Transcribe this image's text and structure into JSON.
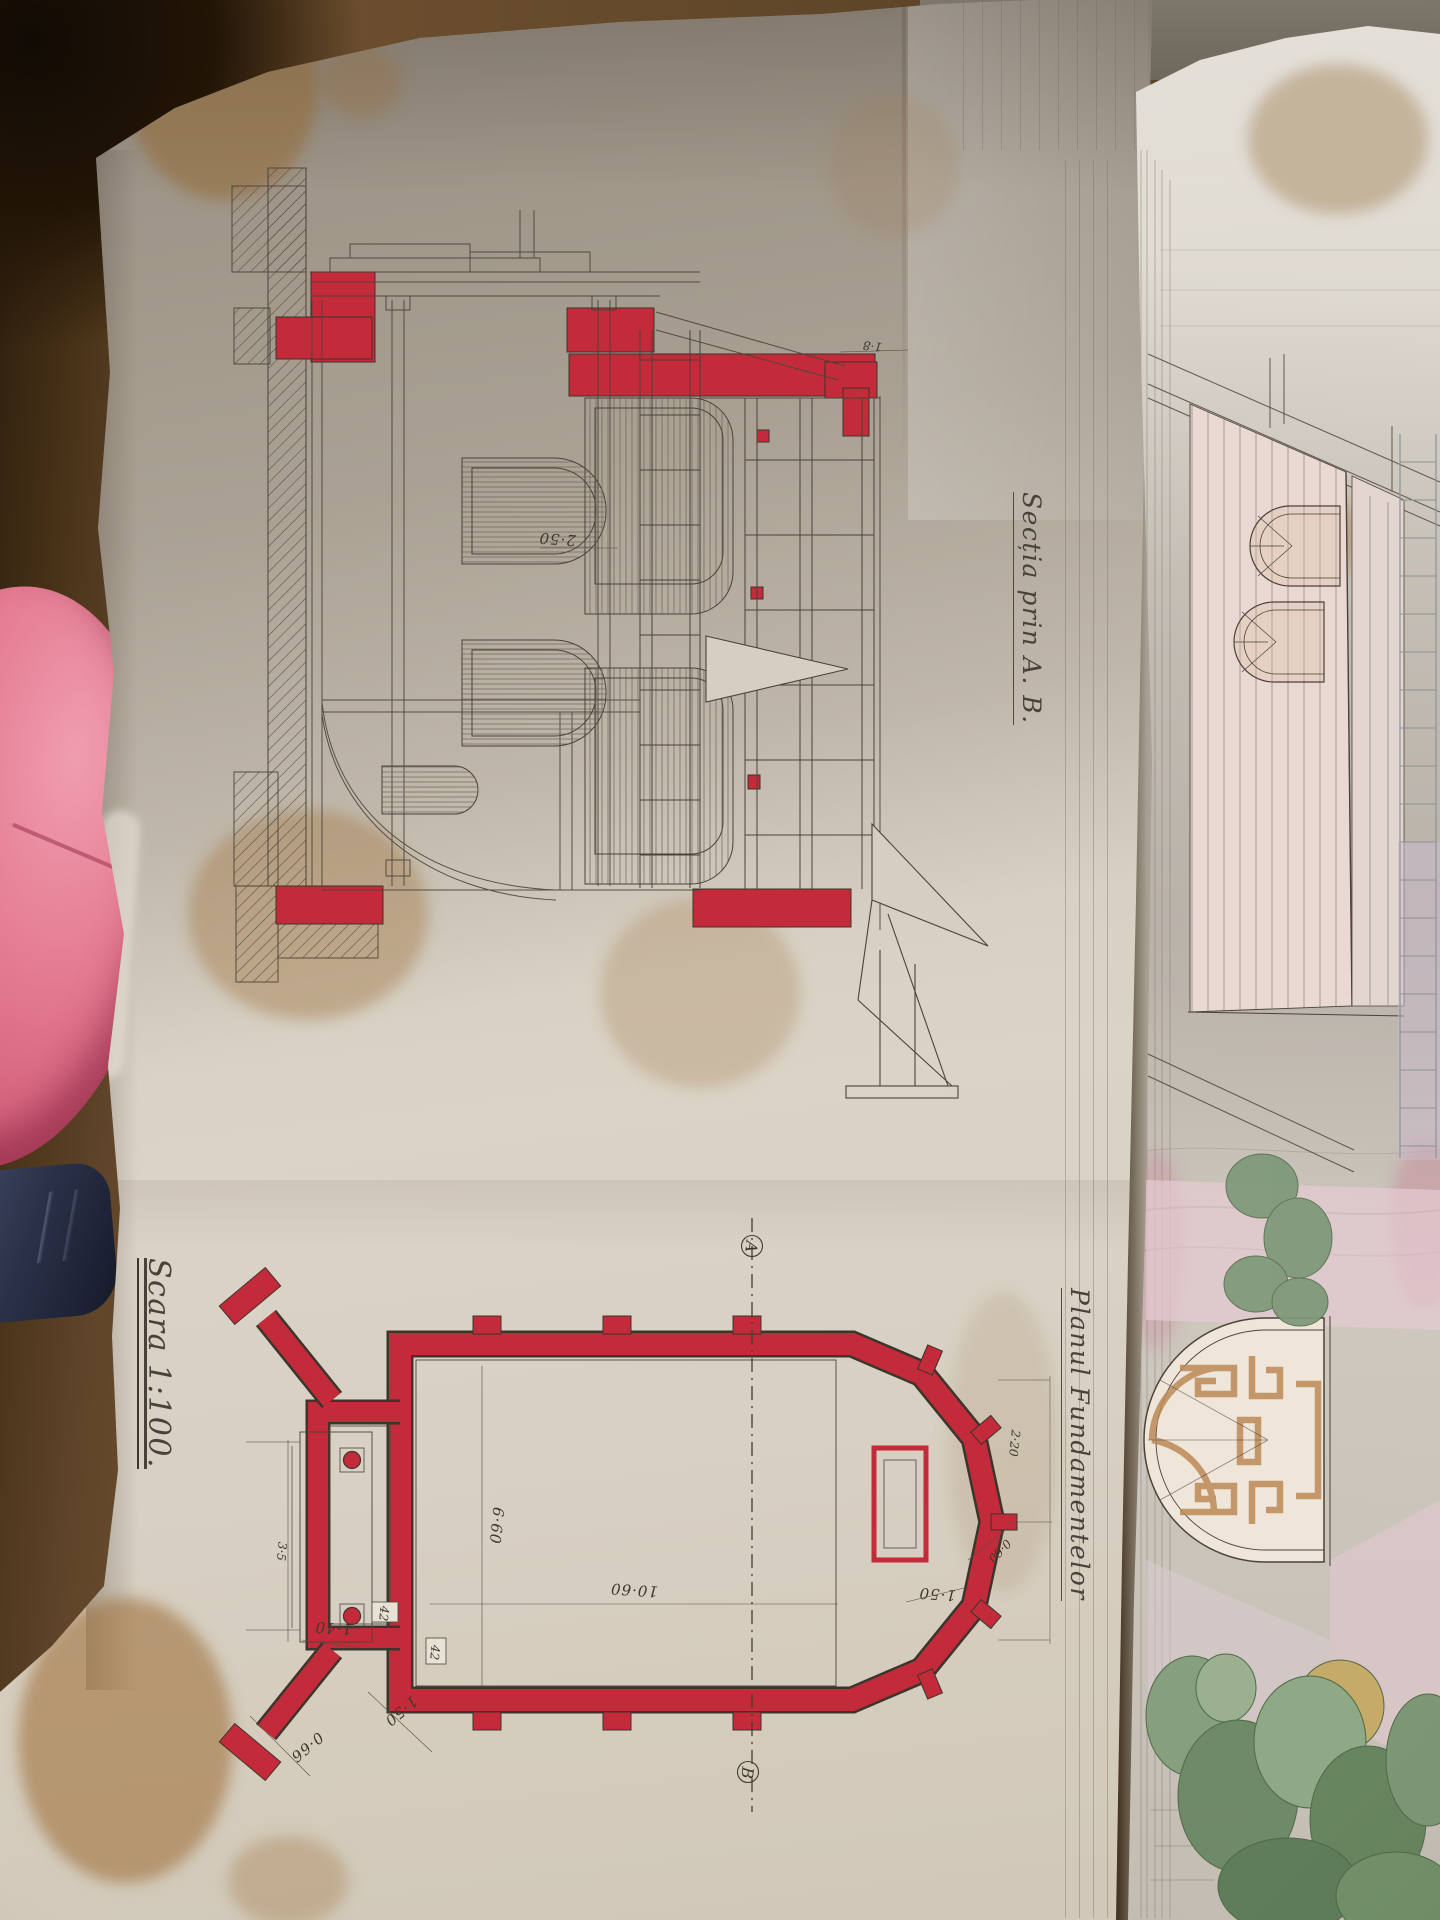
{
  "colors": {
    "red_ink": "#c32b3a",
    "ink": "#4b4339",
    "paper_left": "#d6cec1",
    "paper_right": "#dcd6cc",
    "pink_object": "#d6647e",
    "fabric_patch": "#2b3147",
    "wood_table": "#5e4528",
    "foliage": "#74906e",
    "pink_wall": "#ead8d3",
    "fretwork": "#bd8a58",
    "stain": "#b98d55"
  },
  "sheet_left": {
    "section": {
      "title": "Secția prin A. B.",
      "dims": {
        "vault_height": "2·50",
        "cornice": "1·8"
      }
    },
    "plan": {
      "title": "Planul Fundamentelor",
      "scale": "Scara 1:100.",
      "markers": {
        "a": "A",
        "b": "B"
      },
      "dims": {
        "nave_length": "10·60",
        "nave_width": "6·60",
        "porch_depth": "1·40",
        "wall_a": "42",
        "wall_b": "42",
        "wing_length": "1·50",
        "wing_width": "0·66",
        "apse_side": "1·50",
        "apse_diag": "0·60",
        "apse_depth": "2·20",
        "porch_width": "3·5"
      }
    }
  }
}
